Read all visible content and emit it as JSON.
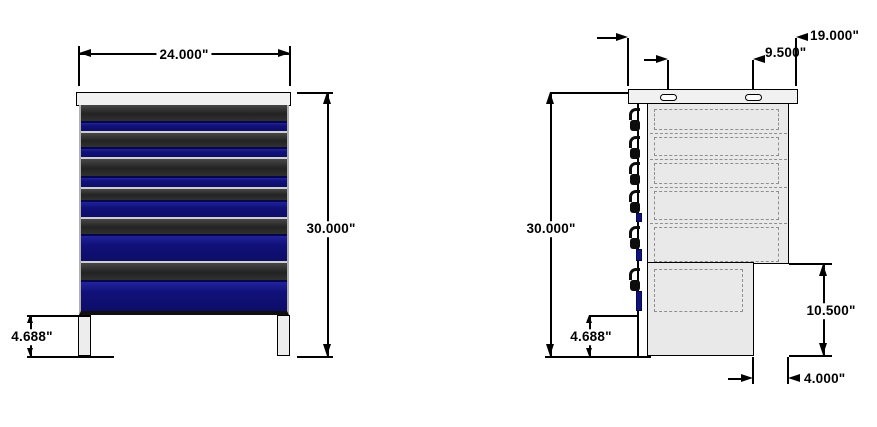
{
  "drawing_type": "2-view dimensioned technical drawing of a drawer cabinet workbench",
  "colors": {
    "drawer_blue": "#11117a",
    "drawer_dark": "#2b2b2b",
    "cabinet_gray": "#e9e9e9",
    "tabletop_gray": "#f1f1f1",
    "dimension_line": "#000000",
    "hidden_line": "#8f8f8f",
    "background": "#ffffff"
  },
  "front_view": {
    "description": "front elevation of 6-drawer cabinet with top surface and two legs",
    "dim_width": "24.000\"",
    "dim_height": "30.000\"",
    "dim_leg": "4.688\"",
    "drawer_count": 6,
    "drawer_heights": [
      28,
      26,
      30,
      30,
      44,
      48
    ],
    "drawer_dark_heights": [
      16,
      14,
      17,
      11,
      15,
      17
    ]
  },
  "side_view": {
    "description": "side elevation with hidden drawer outlines, handle profiles, stepped lower rear notch and slotted top",
    "dim_height": "30.000\"",
    "dim_leg": "4.688\"",
    "dim_top_width": "19.000\"",
    "dim_slot_spacing": "9.500\"",
    "dim_notch_height": "10.500\"",
    "dim_notch_depth": "4.000\"",
    "drawer_tops": [
      105,
      133,
      159,
      187,
      223,
      265
    ],
    "drawer_area_bottom": 315,
    "blue_strip_heights": [
      0,
      0,
      0,
      9,
      12,
      20
    ]
  }
}
